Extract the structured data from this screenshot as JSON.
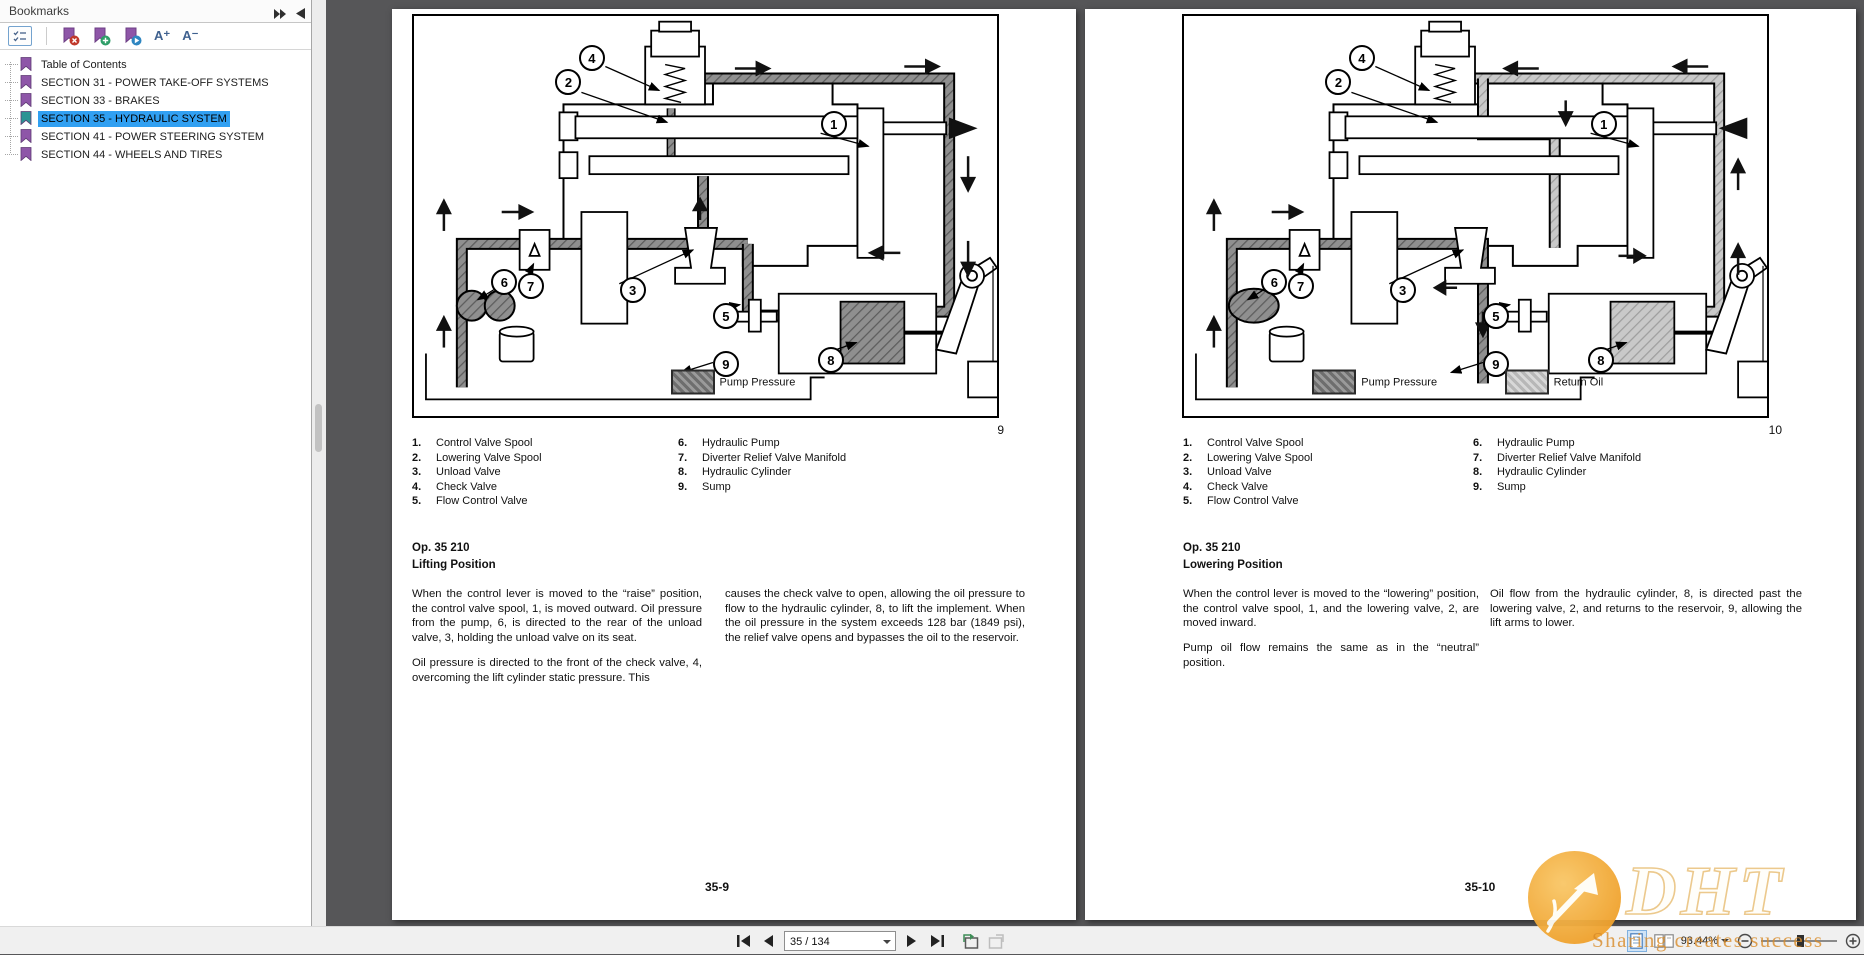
{
  "bookmarks": {
    "title": "Bookmarks",
    "font_increase_label": "A⁺",
    "font_decrease_label": "A⁻",
    "items": [
      {
        "label": "Table of Contents"
      },
      {
        "label": "SECTION 31 - POWER TAKE-OFF SYSTEMS"
      },
      {
        "label": "SECTION 33 - BRAKES"
      },
      {
        "label": "SECTION 35 - HYDRAULIC SYSTEM",
        "selected": true
      },
      {
        "label": "SECTION 41 - POWER STEERING SYSTEM"
      },
      {
        "label": "SECTION 44 - WHEELS AND TIRES"
      }
    ]
  },
  "pages": {
    "left": {
      "figure": {
        "number": "9",
        "legend": [
          {
            "label": "Pump Pressure",
            "variant": "dark",
            "x": 44,
            "y": 91.5
          }
        ],
        "callouts": [
          {
            "n": "4",
            "x": 30.5,
            "y": 10.5
          },
          {
            "n": "2",
            "x": 26.5,
            "y": 16.5
          },
          {
            "n": "1",
            "x": 72,
            "y": 27
          },
          {
            "n": "6",
            "x": 15.5,
            "y": 66.5
          },
          {
            "n": "7",
            "x": 20,
            "y": 67.5
          },
          {
            "n": "3",
            "x": 37.5,
            "y": 68.5
          },
          {
            "n": "5",
            "x": 53.5,
            "y": 75
          },
          {
            "n": "8",
            "x": 71.5,
            "y": 86
          },
          {
            "n": "9",
            "x": 53.5,
            "y": 87
          }
        ]
      },
      "parts_col1": [
        {
          "n": "1.",
          "label": "Control Valve Spool"
        },
        {
          "n": "2.",
          "label": "Lowering Valve Spool"
        },
        {
          "n": "3.",
          "label": "Unload Valve"
        },
        {
          "n": "4.",
          "label": "Check Valve"
        },
        {
          "n": "5.",
          "label": "Flow Control Valve"
        }
      ],
      "parts_col2": [
        {
          "n": "6.",
          "label": "Hydraulic Pump"
        },
        {
          "n": "7.",
          "label": "Diverter Relief Valve Manifold"
        },
        {
          "n": "8.",
          "label": "Hydraulic Cylinder"
        },
        {
          "n": "9.",
          "label": "Sump"
        }
      ],
      "op_label": "Op. 35 210",
      "heading": "Lifting Position",
      "col1_p1": "When the control lever is moved to the “raise” position, the control valve spool, 1, is moved outward. Oil pressure from the pump, 6, is directed to the rear of the unload valve, 3, holding the unload valve on its seat.",
      "col1_p2": "Oil pressure is directed to the front of the check valve, 4, overcoming the lift cylinder static pressure. This",
      "col2_p1": "causes the check valve to open, allowing the oil pressure to flow to the hydraulic cylinder, 8, to lift the implement. When the oil pressure in the system exceeds 128 bar (1849 psi), the relief valve opens and bypasses the oil to the reservoir.",
      "page_number": "35-9"
    },
    "right": {
      "figure": {
        "number": "10",
        "legend": [
          {
            "label": "Pump Pressure",
            "variant": "dark",
            "x": 22,
            "y": 91.5
          },
          {
            "label": "Return Oil",
            "variant": "light",
            "x": 55,
            "y": 91.5
          }
        ],
        "callouts": [
          {
            "n": "4",
            "x": 30.5,
            "y": 10.5
          },
          {
            "n": "2",
            "x": 26.5,
            "y": 16.5
          },
          {
            "n": "1",
            "x": 72,
            "y": 27
          },
          {
            "n": "6",
            "x": 15.5,
            "y": 66.5
          },
          {
            "n": "7",
            "x": 20,
            "y": 67.5
          },
          {
            "n": "3",
            "x": 37.5,
            "y": 68.5
          },
          {
            "n": "5",
            "x": 53.5,
            "y": 75
          },
          {
            "n": "8",
            "x": 71.5,
            "y": 86
          },
          {
            "n": "9",
            "x": 53.5,
            "y": 87
          }
        ]
      },
      "parts_col1": [
        {
          "n": "1.",
          "label": "Control Valve Spool"
        },
        {
          "n": "2.",
          "label": "Lowering Valve Spool"
        },
        {
          "n": "3.",
          "label": "Unload Valve"
        },
        {
          "n": "4.",
          "label": "Check Valve"
        },
        {
          "n": "5.",
          "label": "Flow Control Valve"
        }
      ],
      "parts_col2": [
        {
          "n": "6.",
          "label": "Hydraulic Pump"
        },
        {
          "n": "7.",
          "label": "Diverter Relief Valve Manifold"
        },
        {
          "n": "8.",
          "label": "Hydraulic Cylinder"
        },
        {
          "n": "9.",
          "label": "Sump"
        }
      ],
      "op_label": "Op. 35 210",
      "heading": "Lowering Position",
      "col1_p1": "When the control lever is moved to the “lowering” position, the control valve spool, 1, and the lowering valve, 2, are moved inward.",
      "col1_p2": "Pump oil flow remains the same as in the “neutral” position.",
      "col2_p1": "Oil flow from the hydraulic cylinder, 8, is directed past the lowering valve, 2, and returns to the reservoir, 9, allowing the lift arms to lower.",
      "page_number": "35-10"
    }
  },
  "status_bar": {
    "page_field": "35 / 134",
    "zoom_level": "93.44%"
  },
  "watermark": {
    "logo_text": "DHT",
    "slogan": "Sharing creates success"
  },
  "colors": {
    "selection_blue": "#31a0f2",
    "bookmark_purple": "#8e56a8",
    "bookmark_active_teal": "#2d9494",
    "watermark_orange": "#f2a63b",
    "doc_background": "#565658"
  }
}
